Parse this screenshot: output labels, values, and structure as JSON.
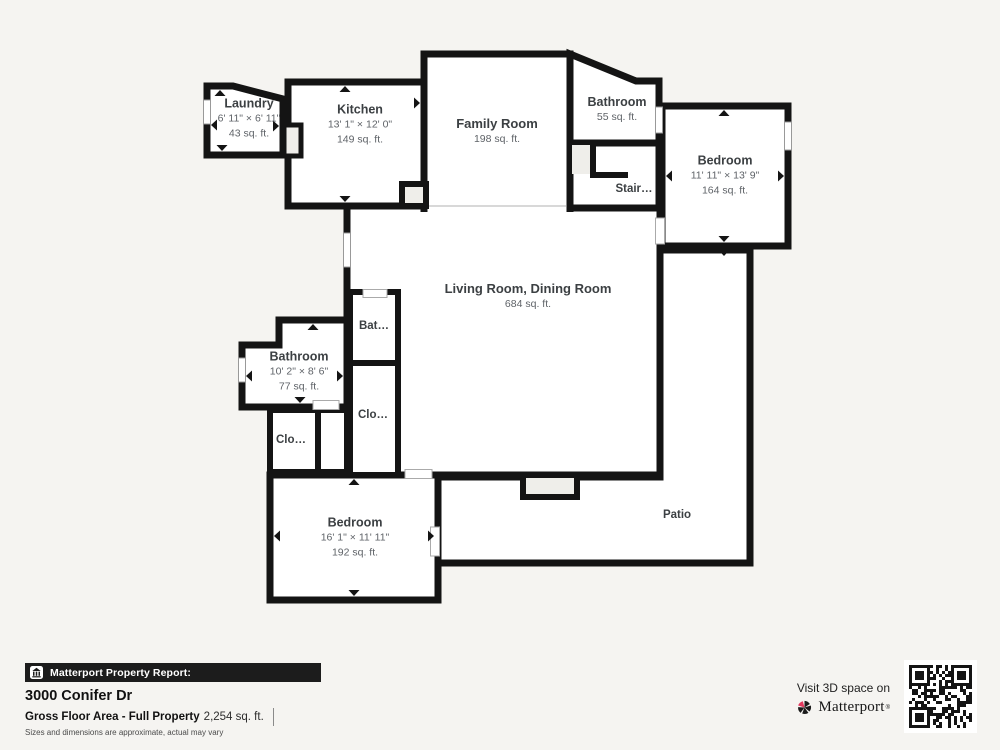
{
  "plan": {
    "rooms": {
      "laundry": {
        "name": "Laundry",
        "dims": "6' 11\" × 6' 11\"",
        "area": "43 sq. ft."
      },
      "kitchen": {
        "name": "Kitchen",
        "dims": "13' 1\" × 12' 0\"",
        "area": "149 sq. ft."
      },
      "family": {
        "name": "Family Room",
        "area": "198 sq. ft."
      },
      "bath_upper": {
        "name": "Bathroom",
        "area": "55 sq. ft."
      },
      "stair": {
        "name": "Stair…"
      },
      "bedroom_upper": {
        "name": "Bedroom",
        "dims": "11' 11\" × 13' 9\"",
        "area": "164 sq. ft."
      },
      "living": {
        "name": "Living Room, Dining Room",
        "area": "684 sq. ft."
      },
      "bath_small": {
        "name": "Bat…"
      },
      "bathroom_left": {
        "name": "Bathroom",
        "dims": "10' 2\" × 8' 6\"",
        "area": "77 sq. ft."
      },
      "closet_right": {
        "name": "Clo…"
      },
      "closet_left": {
        "name": "Clo…"
      },
      "bedroom_lower": {
        "name": "Bedroom",
        "dims": "16' 1\" × 11' 11\"",
        "area": "192 sq. ft."
      },
      "patio": {
        "name": "Patio"
      }
    }
  },
  "footer": {
    "report_label": "Matterport Property Report:",
    "address": "3000 Conifer Dr",
    "area_label": "Gross Floor Area - Full Property",
    "area_value": "2,254 sq. ft.",
    "disclaimer": "Sizes and dimensions are approximate, actual may vary"
  },
  "cta": {
    "line": "Visit 3D space on",
    "brand": "Matterport",
    "trademark": "®"
  },
  "icons": {
    "report_icon": "building-icon",
    "brand_icon": "matterport-pinwheel-icon",
    "qr": "qr-code"
  },
  "colors": {
    "background": "#f5f4f1",
    "wall": "#141414",
    "accent_pink": "#e23a5f"
  }
}
